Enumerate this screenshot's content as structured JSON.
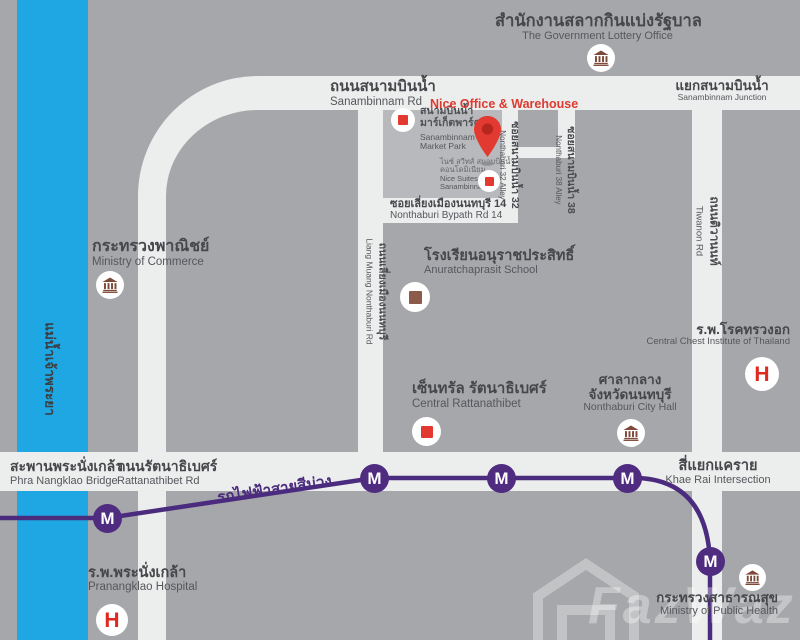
{
  "map": {
    "colors": {
      "background": "#a5a7aa",
      "road": "#eceded",
      "river_blue": "#1ea7e2",
      "metro_purple": "#4b2b7e",
      "marker_red": "#e23a30",
      "bank_brown": "#7d4a39",
      "highlight_block": "#b8b9bc"
    },
    "river": {
      "label_th": "แม่น้ำเจ้าพระยา"
    },
    "roads": {
      "sanambinnam": {
        "th": "ถนนสนามบินน้ำ",
        "en": "Sanambinnam Rd"
      },
      "junction": {
        "th": "แยกสนามบินน้ำ",
        "en": "Sanambinnam Junction"
      },
      "soi32": {
        "th": "ซอยสนามบินน้ำ 32",
        "en": "Nonthaburi 32 Alley"
      },
      "soi38": {
        "th": "ซอยสนามบินน้ำ 38",
        "en": "Nonthaburi 38 Alley"
      },
      "bypath": {
        "th": "ซอยเลี่ยงเมืองนนทบุรี 14",
        "en": "Nonthaburi Bypath Rd 14"
      },
      "liang_muang": {
        "th": "ถนนเลี่ยงเมืองนนทบุรี",
        "en": "Liang Muang Nonthaburi Rd"
      },
      "tiwanon": {
        "th": "ถนนติวานนท์",
        "en": "Tiwanon Rd"
      },
      "rattanathibet": {
        "th": "ถนนรัตนาธิเบศร์",
        "en": "Rattanathibet Rd"
      },
      "bridge": {
        "th": "สะพานพระนั่งเกล้า",
        "en": "Phra Nangklao Bridge"
      },
      "khae_rai": {
        "th": "สี่แยกแคราย",
        "en": "Khae Rai Intersection"
      }
    },
    "transit": {
      "line_label_th": "รถไฟฟ้าสายสีม่วง",
      "station_symbol": "M"
    },
    "pois": {
      "lottery": {
        "th": "สำนักงานสลากกินแบ่งรัฐบาล",
        "en": "The Government Lottery Office"
      },
      "nice_office": {
        "name": "Nice Office & Warehouse"
      },
      "market_park": {
        "th1": "สนามบินน้ำ",
        "th2": "มาร์เก็ตพาร์ค",
        "en1": "Sanambinnam",
        "en2": "Market Park"
      },
      "nice_suites": {
        "th1": "ไนซ์ สวีทส์ สนามบินน้ำ",
        "th2": "คอนโดมิเนียม",
        "en1": "Nice Suites",
        "en2": "Sanambinnam"
      },
      "commerce": {
        "th": "กระทรวงพาณิชย์",
        "en": "Ministry of Commerce"
      },
      "school": {
        "th": "โรงเรียนอนุราชประสิทธิ์",
        "en": "Anuratchaprasit School"
      },
      "central": {
        "th": "เซ็นทรัล รัตนาธิเบศร์",
        "en": "Central Rattanathibet"
      },
      "city_hall": {
        "th1": "ศาลากลาง",
        "th2": "จังหวัดนนทบุรี",
        "en": "Nonthaburi City Hall"
      },
      "chest": {
        "th": "ร.พ.โรคทรวงอก",
        "en": "Central Chest Institute of Thailand"
      },
      "pranangklao": {
        "th": "ร.พ.พระนั่งเกล้า",
        "en": "Pranangklao Hospital"
      },
      "health": {
        "th": "กระทรวงสาธารณสุข",
        "en": "Ministry of Public Health"
      }
    },
    "icons": {
      "hospital_symbol": "H"
    },
    "watermark": {
      "text": "FazWaz"
    }
  }
}
